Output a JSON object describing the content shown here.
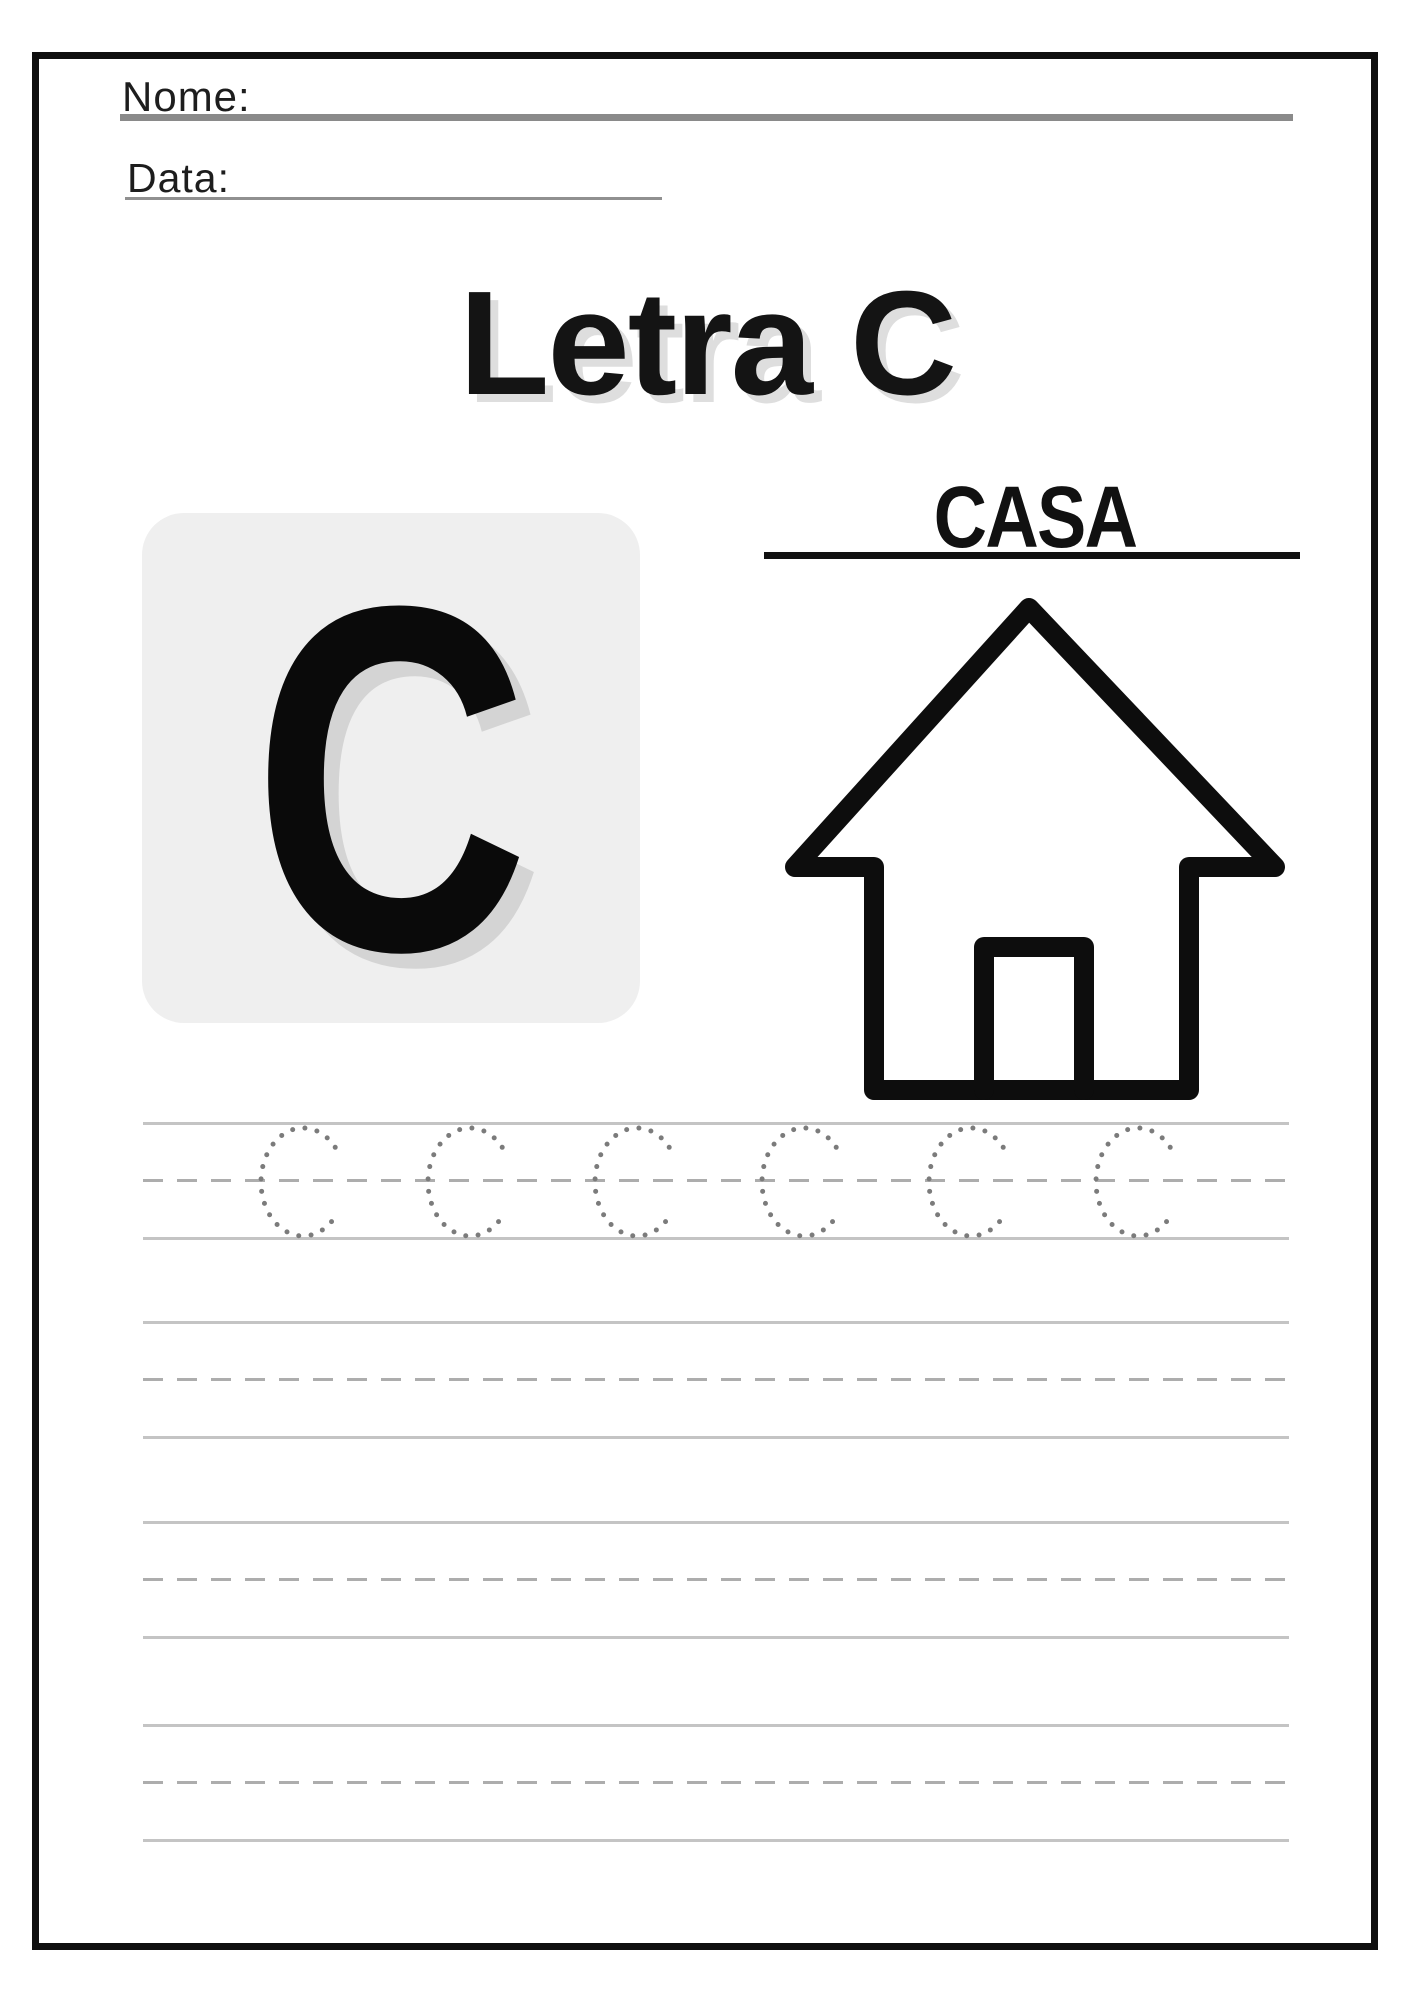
{
  "worksheet": {
    "name_label": "Nome:",
    "date_label": "Data:",
    "title": "Letra C",
    "card_letter": "C",
    "word": "CASA",
    "word_icon": "house-icon",
    "trace_letters": [
      "C",
      "C",
      "C",
      "C",
      "C",
      "C"
    ],
    "writing_rows": 4
  },
  "colors": {
    "frame": "#0f0f0f",
    "title_text": "#141414",
    "title_shadow": "#dedede",
    "card_bg": "#efefef",
    "card_letter": "#0a0a0a",
    "card_letter_shadow": "#d4d4d4",
    "underline_name": "#8a8a8a",
    "underline_date": "#909090",
    "word_underline": "#111111",
    "line_solid": "#c4c4c4",
    "line_dashed": "#adadad",
    "trace_dots": "#7b7b7b",
    "house_stroke": "#0d0d0d"
  }
}
